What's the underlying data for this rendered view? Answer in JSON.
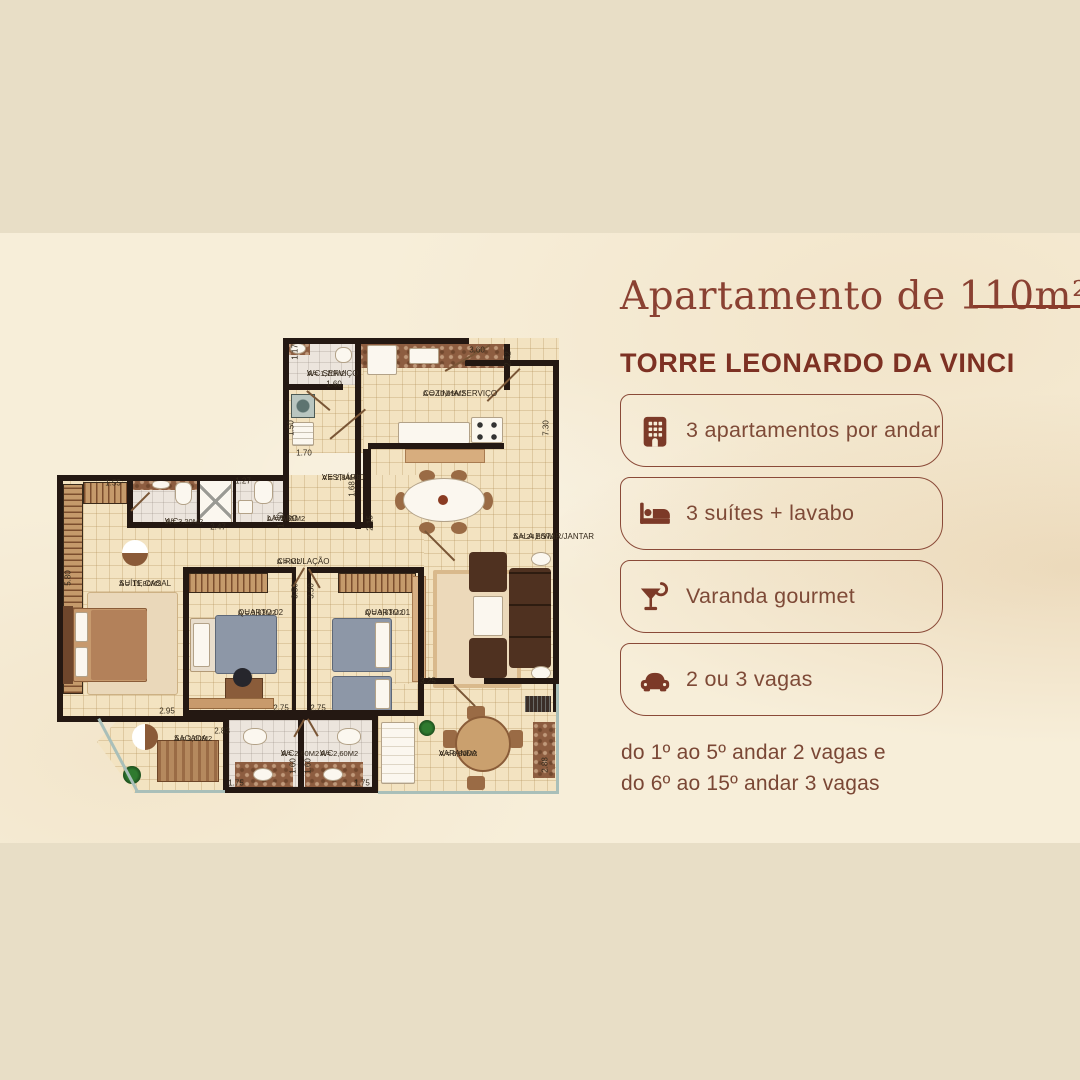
{
  "page": {
    "title": "Apartamento de 110m²",
    "tower": "TORRE LEONARDO DA VINCI",
    "features": [
      {
        "icon": "building-icon",
        "label": "3 apartamentos por andar"
      },
      {
        "icon": "bed-icon",
        "label": "3 suítes + lavabo"
      },
      {
        "icon": "cocktail-icon",
        "label": "Varanda gourmet"
      },
      {
        "icon": "car-icon",
        "label": "2 ou 3 vagas"
      }
    ],
    "note_line1": "do 1º ao 5º andar 2 vagas e",
    "note_line2": "do 6º ao 15º andar 3 vagas"
  },
  "colors": {
    "accent_brown": "#7c3a28",
    "title_brown": "#8a4132",
    "outer_background": "#e8dec6",
    "paper_background": "#f7eed9",
    "wall_black": "#241812",
    "floor_tile": "#f3e3c1",
    "balcony_edge": "#a9bfb9"
  },
  "floor_plan": {
    "rooms": [
      {
        "name": "WC SERVIÇO",
        "area": "A = 1,70M2",
        "x": 250,
        "y": 31
      },
      {
        "name": "COZINHA/SERVIÇO",
        "area": "A = 10,65M2",
        "x": 366,
        "y": 51
      },
      {
        "name": "VESTIÁRIO",
        "area": "A = 2,84M2",
        "x": 265,
        "y": 135
      },
      {
        "name": "WC",
        "area": "A = 3,20M2",
        "x": 108,
        "y": 179
      },
      {
        "name": "LAVABO",
        "area": "A = 1,65M2",
        "x": 210,
        "y": 176
      },
      {
        "name": "CIRCULAÇÃO",
        "area": "A = M2",
        "x": 220,
        "y": 219
      },
      {
        "name": "SALA ESTAR/JANTAR",
        "area": "A = 24,80M2",
        "x": 456,
        "y": 194
      },
      {
        "name": "SUÍTE CASAL",
        "area": "A = 15,80M2",
        "x": 62,
        "y": 241
      },
      {
        "name": "QUARTO 02",
        "area": "A = 9,63M2",
        "x": 181,
        "y": 270
      },
      {
        "name": "QUARTO 01",
        "area": "A = 9,63M2",
        "x": 308,
        "y": 270
      },
      {
        "name": "SACADA",
        "area": "A = 3,60M2",
        "x": 117,
        "y": 396
      },
      {
        "name": "WC",
        "area": "A = 2,60M2",
        "x": 224,
        "y": 411
      },
      {
        "name": "WC",
        "area": "A = 2,60M2",
        "x": 263,
        "y": 411
      },
      {
        "name": "VARANDA",
        "area": "A = 8,80M2",
        "x": 382,
        "y": 411
      }
    ],
    "dimensions": [
      {
        "text": "1.17",
        "x": 238,
        "y": 14,
        "v": true
      },
      {
        "text": "1.60",
        "x": 277,
        "y": 46,
        "v": false
      },
      {
        "text": "3.60",
        "x": 420,
        "y": 12,
        "v": false
      },
      {
        "text": "2.42",
        "x": 451,
        "y": 21,
        "v": true
      },
      {
        "text": "1.50",
        "x": 234,
        "y": 90,
        "v": true
      },
      {
        "text": "1.70",
        "x": 247,
        "y": 115,
        "v": false
      },
      {
        "text": "7.30",
        "x": 489,
        "y": 90,
        "v": true
      },
      {
        "text": "1.68",
        "x": 295,
        "y": 151,
        "v": true
      },
      {
        "text": "2.15",
        "x": 313,
        "y": 185,
        "v": true
      },
      {
        "text": "1.27",
        "x": 186,
        "y": 143,
        "v": false
      },
      {
        "text": "1.30",
        "x": 224,
        "y": 182,
        "v": true
      },
      {
        "text": "2.47",
        "x": 161,
        "y": 189,
        "v": false
      },
      {
        "text": "1.55",
        "x": 56,
        "y": 145,
        "v": false
      },
      {
        "text": "5.80",
        "x": 11,
        "y": 240,
        "v": true
      },
      {
        "text": "2.95",
        "x": 110,
        "y": 373,
        "v": false
      },
      {
        "text": "3.50",
        "x": 238,
        "y": 253,
        "v": true
      },
      {
        "text": "3.50",
        "x": 254,
        "y": 253,
        "v": true
      },
      {
        "text": "2.75",
        "x": 224,
        "y": 370,
        "v": false
      },
      {
        "text": "2.75",
        "x": 261,
        "y": 370,
        "v": false
      },
      {
        "text": "3.25",
        "x": 371,
        "y": 343,
        "v": false
      },
      {
        "text": "2.83",
        "x": 165,
        "y": 393,
        "v": false
      },
      {
        "text": "1.75",
        "x": 179,
        "y": 445,
        "v": false
      },
      {
        "text": "1.75",
        "x": 305,
        "y": 445,
        "v": false
      },
      {
        "text": "1.60",
        "x": 236,
        "y": 428,
        "v": true
      },
      {
        "text": "1.60",
        "x": 251,
        "y": 428,
        "v": true
      },
      {
        "text": "2.88",
        "x": 488,
        "y": 427,
        "v": true
      }
    ]
  }
}
